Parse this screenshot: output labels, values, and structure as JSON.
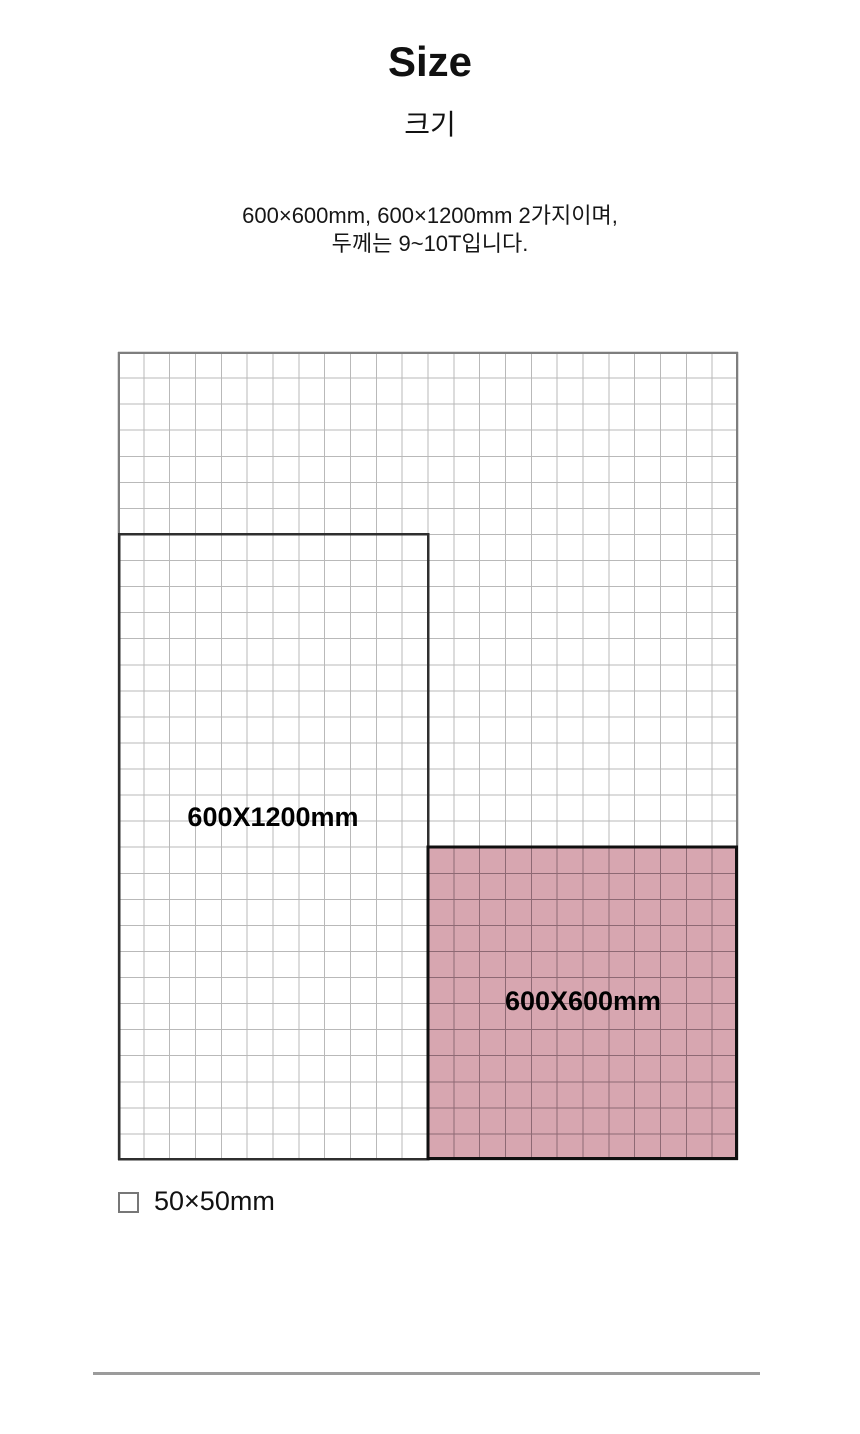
{
  "header": {
    "title": "Size",
    "subtitle": "크기",
    "description": [
      "600×600mm, 600×1200mm 2가지이며,",
      "두께는 9~10T입니다."
    ]
  },
  "diagram": {
    "type": "size-comparison-grid",
    "unit_mm_per_cell": 50,
    "grid_cols": 24,
    "grid_rows": 31,
    "colors": {
      "grid_line": "#b9b9b9",
      "grid_border": "#7e7e7e",
      "rect_1200_border": "#2f2f2f",
      "rect_600_border": "#101010",
      "rect_600_fill": "#d7a6b0",
      "rect_600_grid_line": "#8e6974"
    },
    "rect_1200": {
      "label": "600X1200mm",
      "col": 0,
      "row": 7,
      "cols": 12,
      "rows": 24
    },
    "rect_600": {
      "label": "600X600mm",
      "col": 12,
      "row": 19,
      "cols": 12,
      "rows": 12
    }
  },
  "legend": {
    "label": "50×50mm"
  }
}
